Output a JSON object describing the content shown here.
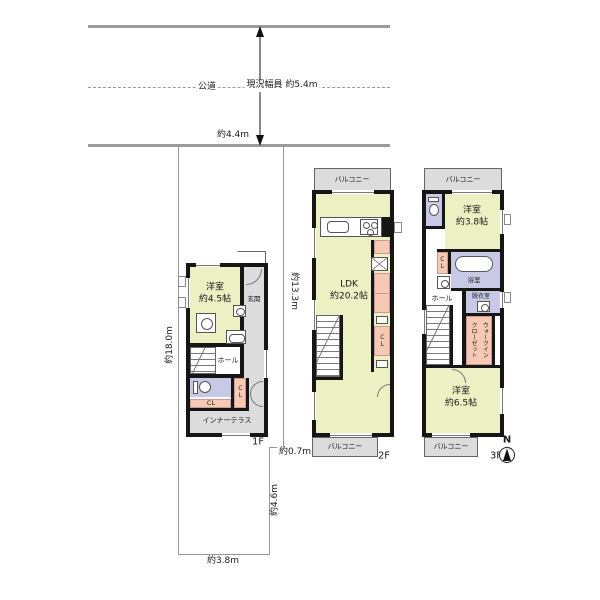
{
  "colors": {
    "room_yellow": "#edf0c3",
    "service_gray": "#dcdcdc",
    "wet_lavender": "#c7c9e6",
    "storage_pink": "#f6c9b2",
    "wall_black": "#161616"
  },
  "road": {
    "public_road": "公道",
    "width_note": "現況幅員\n約5.4m",
    "frontage": "約4.4m"
  },
  "site": {
    "west": "約18.0m",
    "east_upper": "約13.3m",
    "east_step": "約0.7m",
    "east_lower": "約4.6m",
    "south": "約3.8m"
  },
  "floors": {
    "f1": {
      "label": "1F",
      "room45": "洋室\n約4.5帖",
      "entrance": "玄関",
      "hall": "ホール",
      "closet_a": "CL",
      "closet_b": "CL",
      "inner_terrace": "インナーテラス"
    },
    "f2": {
      "label": "2F",
      "balcony_top": "バルコニー",
      "ldk": "LDK\n約20.2帖",
      "closet": "CL",
      "balcony_bottom": "バルコニー"
    },
    "f3": {
      "label": "3F",
      "balcony_top": "バルコニー",
      "room38": "洋室\n約3.8帖",
      "closet": "CL",
      "bath": "浴室",
      "hall": "ホール",
      "dressing": "脱衣室",
      "walk_in_closet": "ウォークイン\nクローゼット",
      "room65": "洋室\n約6.5帖",
      "balcony_bottom": "バルコニー"
    }
  },
  "compass": {
    "north": "N"
  }
}
